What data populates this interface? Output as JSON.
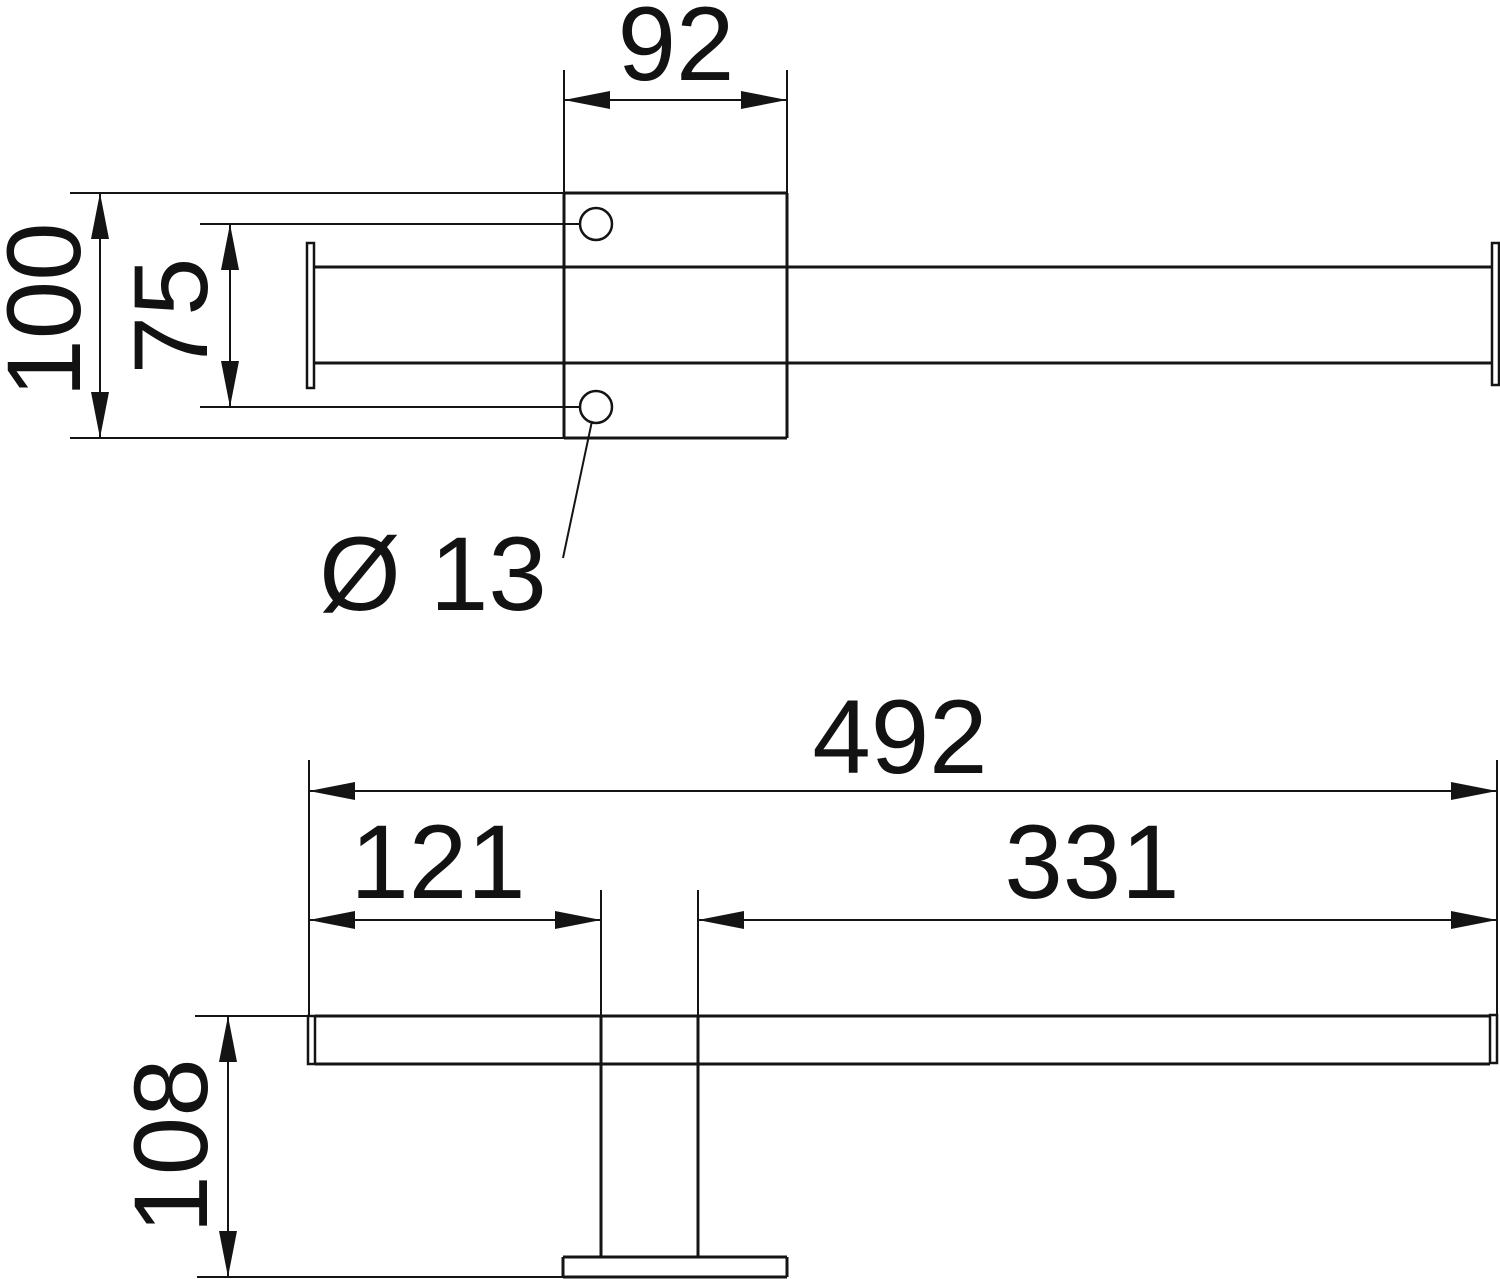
{
  "drawing": {
    "kind": "technical-dimension-drawing",
    "background": "#ffffff",
    "line_color": "#141414",
    "views": [
      {
        "id": "top-view",
        "dimensions": [
          {
            "id": "plate-width",
            "value": "92"
          },
          {
            "id": "plate-height",
            "value": "100"
          },
          {
            "id": "hole-spacing",
            "value": "75"
          },
          {
            "id": "hole-diameter",
            "value": "Ø 13"
          }
        ]
      },
      {
        "id": "side-view",
        "dimensions": [
          {
            "id": "overall-length",
            "value": "492"
          },
          {
            "id": "offset-left",
            "value": "121"
          },
          {
            "id": "offset-right",
            "value": "331"
          },
          {
            "id": "stand-height",
            "value": "108"
          }
        ]
      }
    ]
  }
}
